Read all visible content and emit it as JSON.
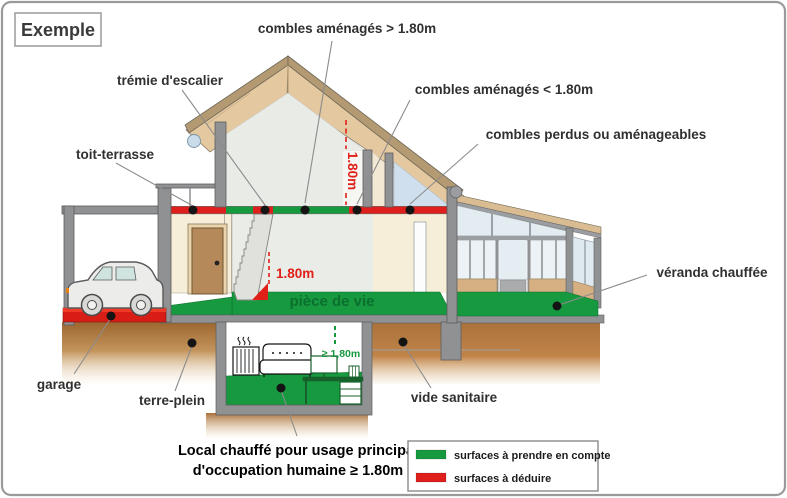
{
  "example_badge": "Exemple",
  "labels": {
    "combles_sup": "combles aménagés > 1.80m",
    "tremie": "trémie d'escalier",
    "combles_inf": "combles aménagés < 1.80m",
    "toit_terrasse": "toit-terrasse",
    "combles_perdus": "combles perdus ou aménageables",
    "veranda": "véranda chauffée",
    "garage": "garage",
    "terre_plein": "terre-plein",
    "vide_sanitaire": "vide sanitaire",
    "piece_de_vie": "pièce de vie",
    "local_line1": "Local chauffé pour usage principal",
    "local_line2": "d'occupation humaine ≥ 1.80m"
  },
  "dimensions": {
    "attic_height": "1.80m",
    "stairs_height": "1.80m",
    "basement_height": "≥ 1,80m"
  },
  "legend": {
    "items": [
      {
        "label": "surfaces à prendre en compte",
        "color": "#17993f"
      },
      {
        "label": "surfaces à déduire",
        "color": "#de1f1b"
      }
    ]
  },
  "colors": {
    "surface_count_green": "#17993f",
    "surface_deduct_red": "#de1f1b",
    "dimension_red": "#e02018"
  }
}
